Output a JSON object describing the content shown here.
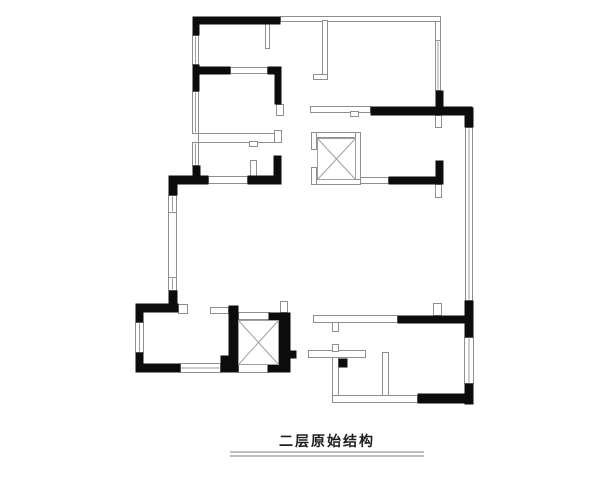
{
  "title": {
    "text": "二层原始结构",
    "underline_rules": [
      [
        230,
        452,
        424,
        452
      ],
      [
        230,
        456,
        424,
        456
      ]
    ]
  },
  "drawing": {
    "canvas": {
      "width": 600,
      "height": 480,
      "background": "#ffffff"
    },
    "colors": {
      "wall_fill": "#0c0c0c",
      "thin_stroke": "#8f8f8f",
      "glazing_stroke": "#9b9b9b",
      "xbox_stroke": "#a0a0a0",
      "underline": "#a8a8a8",
      "title_color": "#1f1f1f"
    },
    "black_walls": [
      [
        192,
        16,
        88,
        8
      ],
      [
        192,
        16,
        7,
        19
      ],
      [
        192,
        64,
        7,
        27
      ],
      [
        192,
        66,
        38,
        8
      ],
      [
        267,
        66,
        14,
        8
      ],
      [
        274,
        66,
        7,
        38
      ],
      [
        192,
        165,
        8,
        13
      ],
      [
        168,
        175,
        40,
        9
      ],
      [
        247,
        175,
        34,
        9
      ],
      [
        273,
        155,
        8,
        29
      ],
      [
        168,
        175,
        9,
        20
      ],
      [
        168,
        290,
        9,
        18
      ],
      [
        135,
        303,
        43,
        9
      ],
      [
        135,
        303,
        8,
        19
      ],
      [
        135,
        352,
        8,
        20
      ],
      [
        135,
        363,
        45,
        9
      ],
      [
        220,
        363,
        18,
        9
      ],
      [
        228,
        305,
        10,
        67
      ],
      [
        278,
        312,
        12,
        60
      ],
      [
        268,
        312,
        10,
        8
      ],
      [
        267,
        363,
        23,
        9
      ],
      [
        370,
        106,
        102,
        9
      ],
      [
        435,
        90,
        8,
        16
      ],
      [
        464,
        107,
        9,
        20
      ],
      [
        388,
        176,
        54,
        8
      ],
      [
        435,
        160,
        8,
        24
      ],
      [
        464,
        300,
        9,
        37
      ],
      [
        397,
        315,
        71,
        8
      ],
      [
        464,
        383,
        9,
        21
      ],
      [
        417,
        393,
        56,
        10
      ]
    ],
    "thin_walls": [
      [
        280,
        16,
        160,
        5
      ],
      [
        435,
        21,
        5,
        19
      ],
      [
        322,
        20,
        5,
        58
      ],
      [
        313,
        74,
        14,
        5
      ],
      [
        265,
        23,
        4,
        25
      ],
      [
        230,
        67,
        37,
        6
      ],
      [
        198,
        133,
        77,
        9
      ],
      [
        274,
        130,
        7,
        12
      ],
      [
        250,
        160,
        6,
        16
      ],
      [
        208,
        176,
        39,
        7
      ],
      [
        310,
        106,
        60,
        6
      ],
      [
        360,
        177,
        28,
        6
      ],
      [
        313,
        315,
        84,
        7
      ],
      [
        308,
        350,
        57,
        7
      ],
      [
        332,
        357,
        6,
        45
      ],
      [
        382,
        352,
        6,
        50
      ],
      [
        332,
        395,
        85,
        7
      ],
      [
        332,
        322,
        6,
        9
      ],
      [
        332,
        344,
        6,
        7
      ],
      [
        238,
        312,
        31,
        7
      ],
      [
        238,
        364,
        30,
        8
      ],
      [
        311,
        132,
        49,
        5
      ],
      [
        355,
        132,
        5,
        52
      ],
      [
        311,
        179,
        49,
        5
      ],
      [
        311,
        132,
        5,
        17
      ],
      [
        311,
        167,
        5,
        17
      ],
      [
        350,
        111,
        8,
        5
      ],
      [
        249,
        141,
        8,
        5
      ],
      [
        168,
        212,
        8,
        65
      ]
    ],
    "windows": [
      [
        192,
        35,
        6,
        29
      ],
      [
        192,
        91,
        6,
        42
      ],
      [
        192,
        142,
        6,
        23
      ],
      [
        435,
        40,
        5,
        50
      ],
      [
        465,
        127,
        7,
        173
      ],
      [
        168,
        195,
        8,
        17
      ],
      [
        168,
        277,
        8,
        13
      ],
      [
        135,
        322,
        8,
        30
      ],
      [
        180,
        363,
        40,
        9
      ],
      [
        464,
        337,
        9,
        46
      ]
    ],
    "door_jambs": [
      [
        276,
        104,
        7,
        11
      ],
      [
        435,
        115,
        6,
        12
      ],
      [
        435,
        184,
        6,
        13
      ],
      [
        178,
        304,
        9,
        9
      ],
      [
        210,
        307,
        18,
        6
      ],
      [
        280,
        301,
        7,
        11
      ],
      [
        433,
        303,
        8,
        12
      ]
    ],
    "door_pivots": [
      [
        338,
        358,
        9,
        9
      ],
      [
        220,
        355,
        8,
        8
      ],
      [
        290,
        350,
        6,
        8
      ]
    ],
    "x_boxes": [
      [
        317,
        138,
        38,
        41
      ],
      [
        238,
        320,
        40,
        44
      ]
    ]
  }
}
